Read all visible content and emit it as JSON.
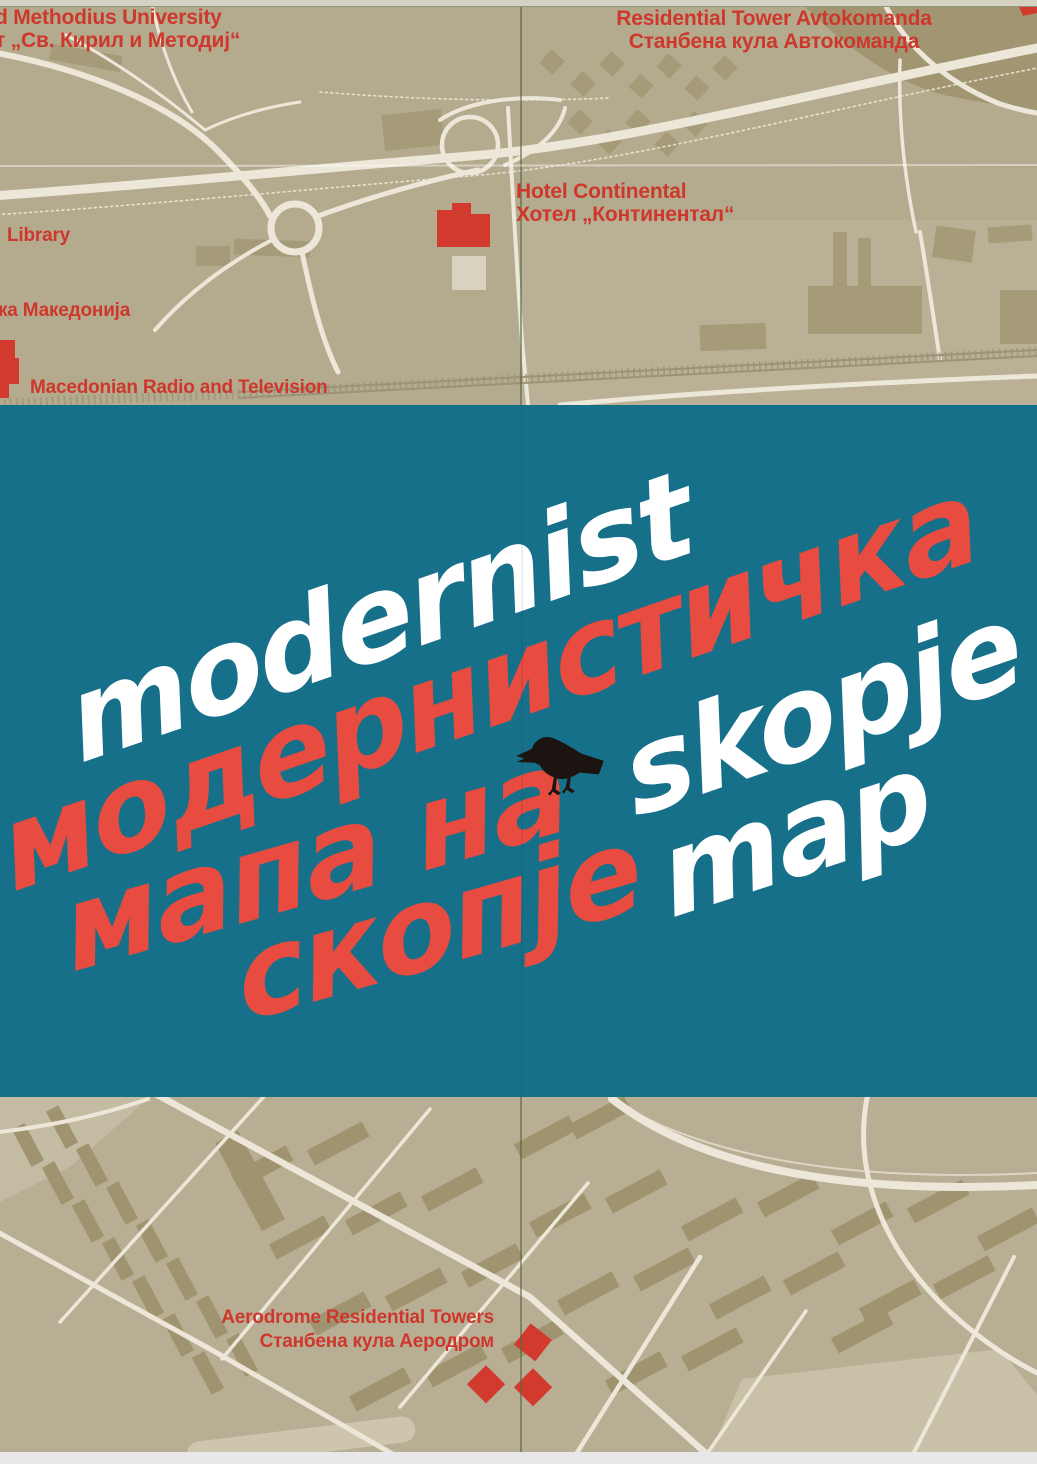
{
  "palette": {
    "teal": "#177089",
    "title_red": "#e84b3f",
    "title_white": "#ffffff",
    "label_red": "#ce382c",
    "map_bg": "#b4aa8e",
    "map_bg_bottom": "#b8ae93",
    "building": "#a69b79",
    "building_dark": "#a0936f",
    "road": "#ece7d8",
    "light_area": "#c7bfa7",
    "marker_red": "#d23a2e",
    "crow_black": "#1c1410",
    "crease_green": "#56673f",
    "edge_top": "#d5d1c3",
    "edge_bottom": "#e8e7e9"
  },
  "top_map": {
    "labels": {
      "university": {
        "en": "d Methodius University",
        "mk": "т „Св. Кирил и Методиј“"
      },
      "avtokomanda": {
        "en": "Residential Tower Avtokomanda",
        "mk": "Станбена кула Автокоманда"
      },
      "hotel": {
        "en": "Hotel Continental",
        "mk": "Хотел „Континентал“"
      },
      "library": {
        "en": "Library"
      },
      "makedonija": {
        "mk": "ка Македонија"
      },
      "mrt": {
        "en": "Macedonian Radio and Television"
      }
    }
  },
  "title": {
    "modernist": "modernist",
    "modernisticka": "модернистичка",
    "mapa_na": "мапа на",
    "skopje_en": "skopje",
    "skopje_mk": "скопје",
    "map_en": "map",
    "crow_icon": "crow-icon"
  },
  "bottom_map": {
    "labels": {
      "aerodrome": {
        "en": "Aerodrome Residential Towers",
        "mk": "Станбена кула Аеродром"
      }
    }
  }
}
